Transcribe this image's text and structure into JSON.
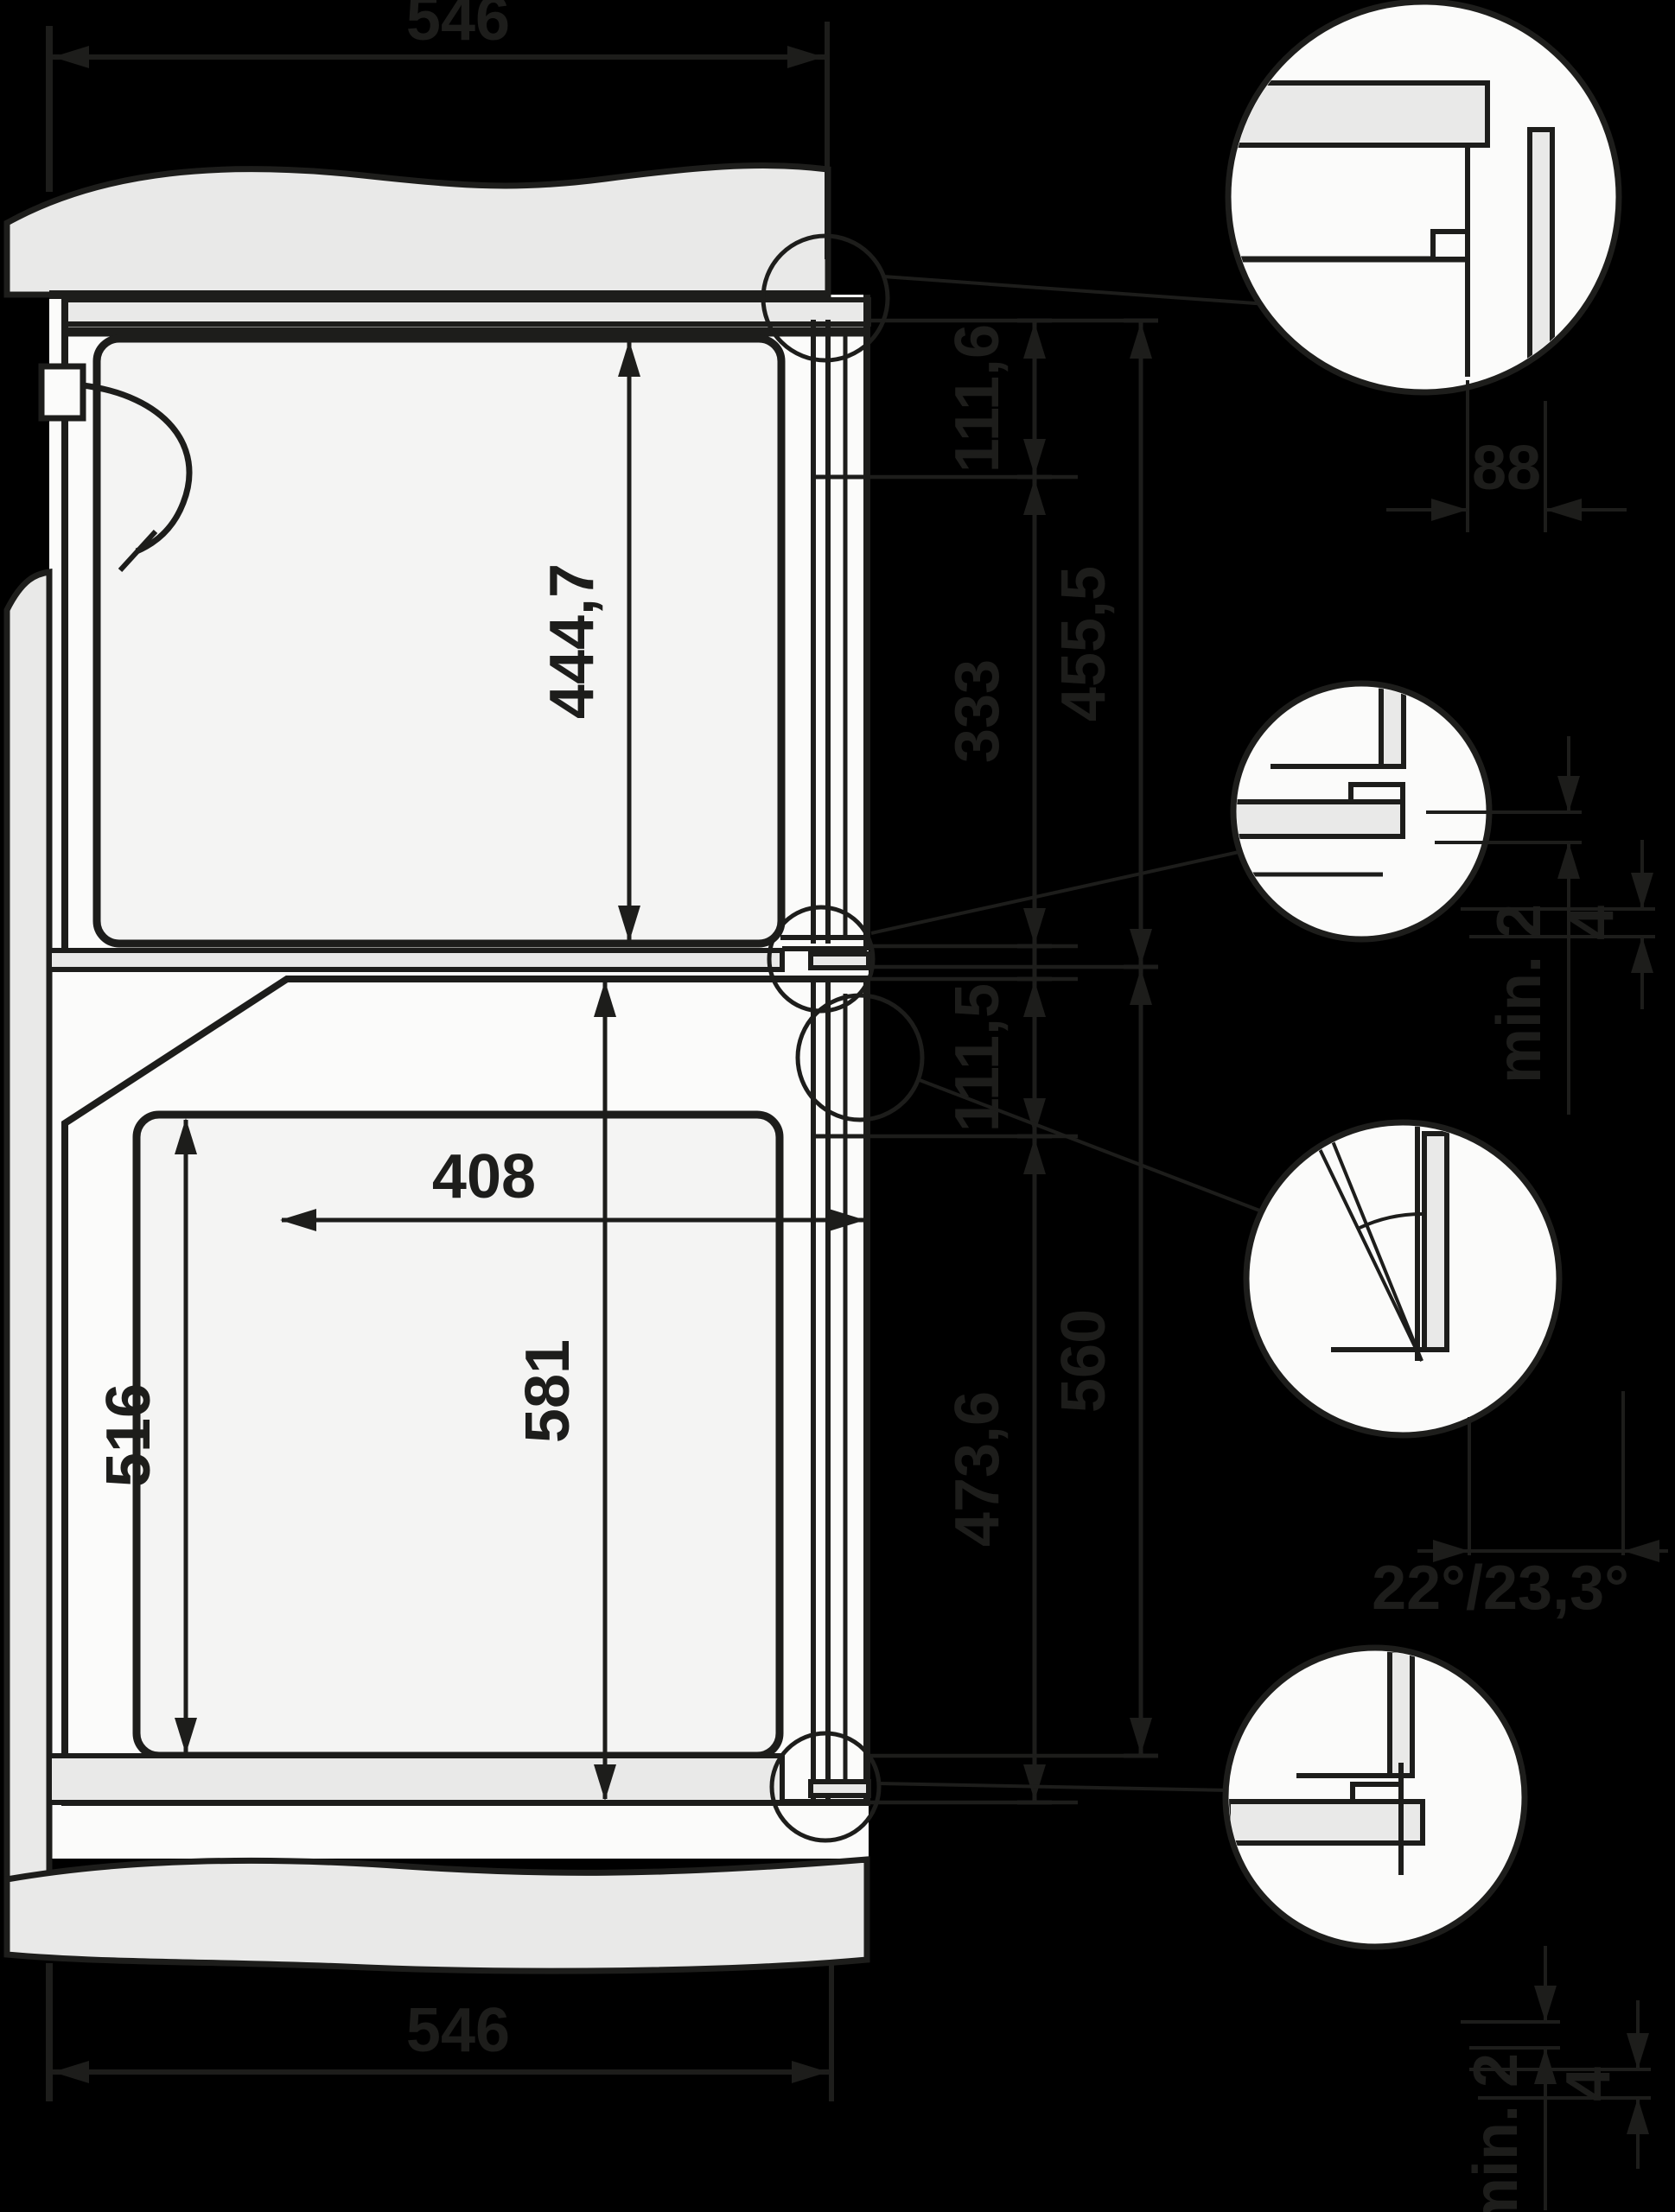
{
  "colors": {
    "background": "#000000",
    "cabinet_panel": "#e9e9e8",
    "appliance_body": "#fbfbfa",
    "cavity_fill": "#f4f4f3",
    "line": "#1d1d1b"
  },
  "dimensions": {
    "top_depth": "546",
    "bottom_depth": "546",
    "upper_front_height": "444,7",
    "upper_panel_height": "111,6",
    "upper_door_height": "333",
    "upper_total_height": "455,5",
    "lower_panel_height": "111,5",
    "lower_front_height": "581",
    "lower_door_height": "473,6",
    "lower_niche_height": "560",
    "lower_cavity_height": "516",
    "lower_cavity_depth": "408"
  },
  "details": {
    "d1_gap": "88",
    "d2_min_gap": "min. 2",
    "d2_overlap": "4",
    "d3_door_angles": "22°/23,3°",
    "d4_min_gap": "min. 2",
    "d4_overlap": "4"
  }
}
